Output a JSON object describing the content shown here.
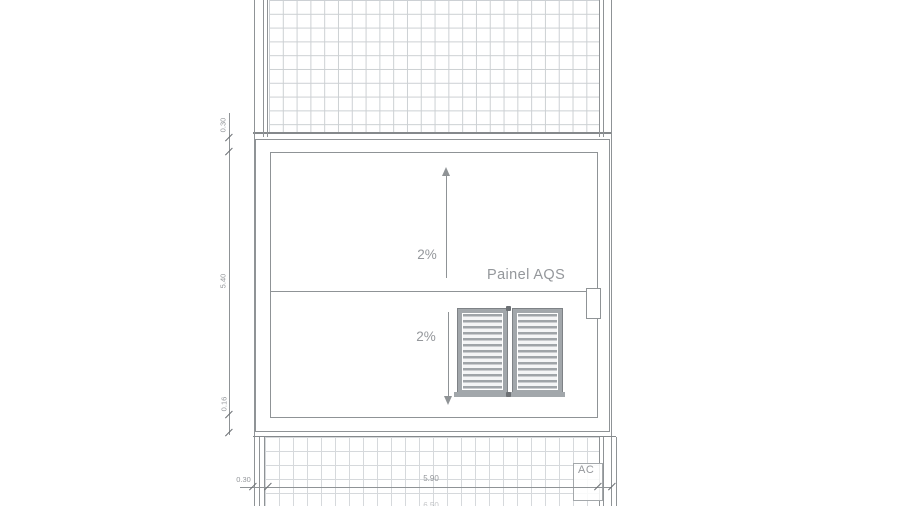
{
  "drawing": {
    "title": "roof-plan-detail",
    "labels": {
      "panel_label": "Painel AQS",
      "slope_upper": "2%",
      "slope_lower": "2%",
      "ac_unit": "AC"
    },
    "dimensions": {
      "left_top": "0.30",
      "left_middle": "5.40",
      "left_bottom": "0.16",
      "bottom_left": "0.30",
      "bottom_main": "5.90",
      "bottom_total_partial": "6.50"
    },
    "colors": {
      "line": "#8f9396",
      "line_dark": "#6c7074",
      "grid_top": "#ccd0d3",
      "grid_bottom": "#d6d9dc",
      "text": "#94979b",
      "frame": "#a2a7ab",
      "frame_dark": "#7e8286",
      "slat": "#9fa4a8",
      "paper": "#ffffff"
    }
  }
}
